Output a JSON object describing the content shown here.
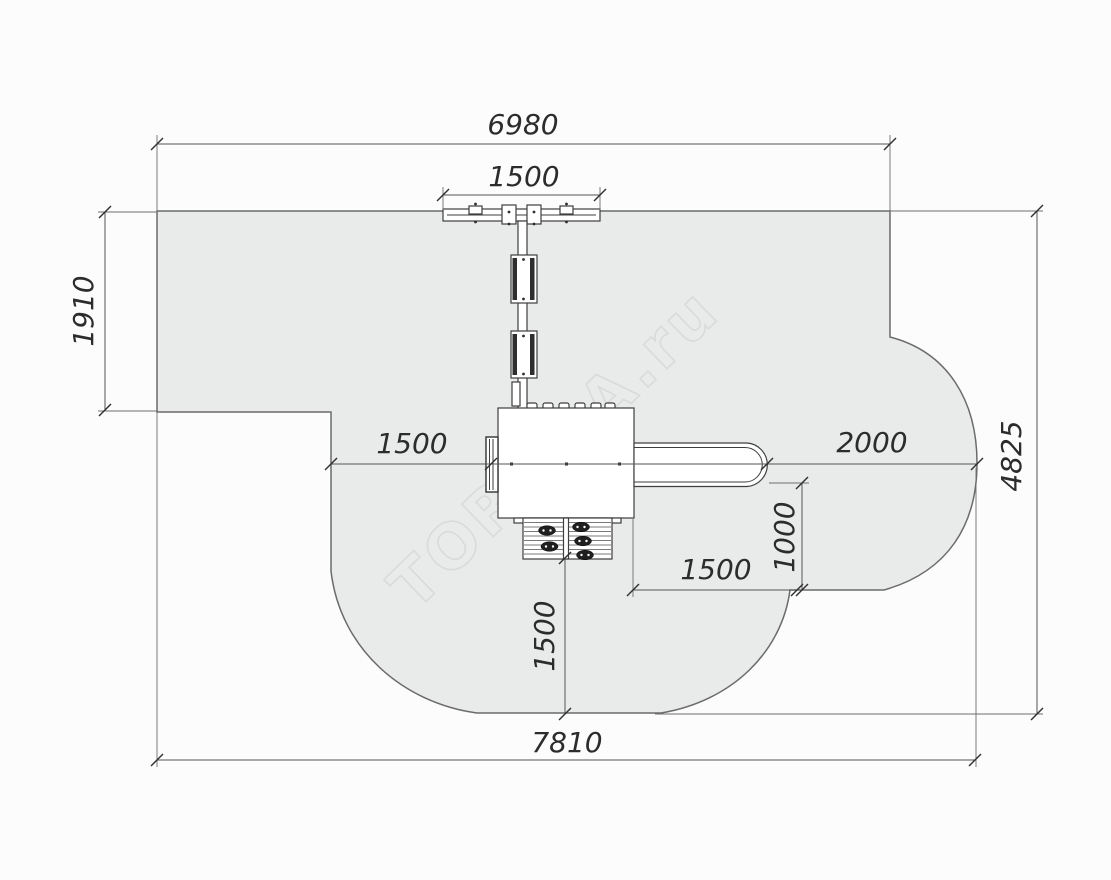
{
  "drawing": {
    "title": "Playground equipment safety-zone plan, top view",
    "units": "mm",
    "watermark": "TORUDA.ru",
    "dims": {
      "top_width": "6980",
      "beam_width": "1500",
      "upper_left_height": "1910",
      "left_clearance": "1500",
      "slide_clearance": "2000",
      "right_height": "4825",
      "exit_depth": "1000",
      "exit_width": "1500",
      "lower_clearance": "1500",
      "bottom_width": "7810"
    },
    "colors": {
      "zone_fill": "#e9eaea",
      "zone_outline": "#6b6b6b",
      "dimension_lines": "#555555",
      "dimension_text": "#2c2c2c",
      "equipment_outline": "#3e3e3e",
      "watermark": "#d9d9d9",
      "background": "#fcfcfc"
    }
  }
}
